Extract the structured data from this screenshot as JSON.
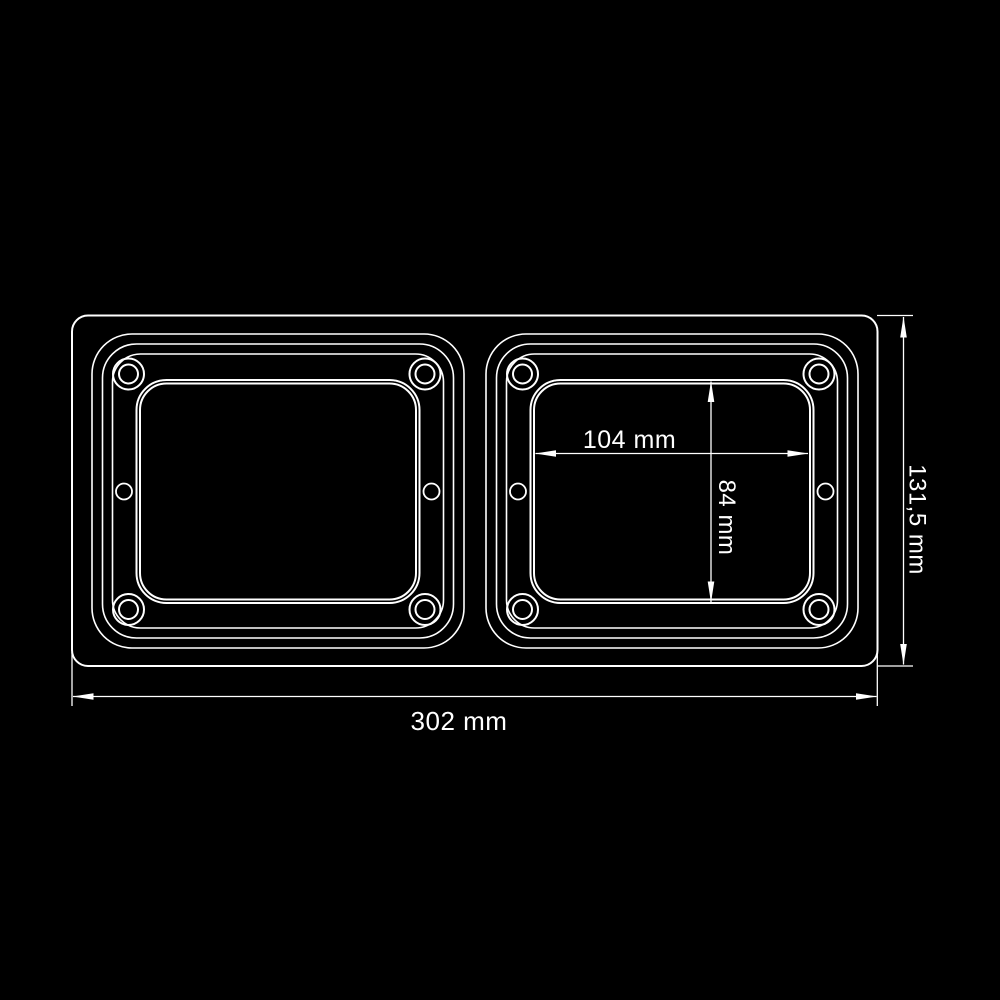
{
  "meta": {
    "type": "technical-drawing",
    "subject": "twin rectangular lamp housing, front view",
    "background_color": "#000000",
    "line_color": "#ffffff"
  },
  "dimensions": {
    "overall_width": {
      "label": "302 mm",
      "value_mm": 302,
      "orientation": "horizontal",
      "position": "bottom"
    },
    "overall_height": {
      "label": "131,5 mm",
      "value_mm": 131.5,
      "orientation": "vertical",
      "position": "right"
    },
    "lens_width": {
      "label": "104 mm",
      "value_mm": 104,
      "orientation": "horizontal",
      "position": "inside-right-lens"
    },
    "lens_height": {
      "label": "84 mm",
      "value_mm": 84,
      "orientation": "vertical",
      "position": "inside-right-lens"
    }
  }
}
